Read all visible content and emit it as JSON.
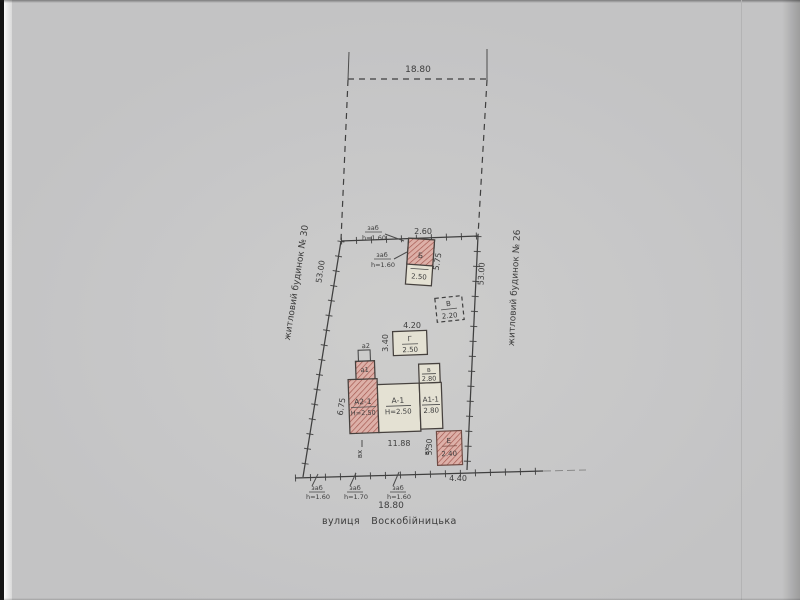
{
  "plan": {
    "street": {
      "prefix": "вулиця",
      "name": "Воскобійницька"
    },
    "neighbor_left": "житловий будинок № 30",
    "neighbor_right": "житловий будинок № 26",
    "dims": {
      "front_top": "18.80",
      "front_bottom": "18.80",
      "side_left": "53.00",
      "side_right": "53.00",
      "corner_right": "4.40"
    },
    "fences": {
      "top_a": {
        "label": "заб",
        "height": "h=1.60"
      },
      "top_b": {
        "label": "заб",
        "height": "h=1.60"
      },
      "bottom_a": {
        "label": "заб",
        "height": "h=1.60"
      },
      "bottom_b": {
        "label": "заб",
        "height": "h=1.70"
      },
      "bottom_c": {
        "label": "заб",
        "height": "h=1.60"
      }
    },
    "buildings": {
      "b": {
        "letter": "Б",
        "value": "2.50",
        "width": "2.60",
        "depth": "5.75"
      },
      "v_shed": {
        "letter": "В",
        "value": "2.20"
      },
      "g": {
        "letter": "Г",
        "value": "2.50",
        "width": "4.20",
        "depth": "3.40"
      },
      "house_a2": {
        "label": "А2-1",
        "height": "Н=2.50",
        "side": "6.75"
      },
      "house_a": {
        "label": "А-1",
        "height": "Н=2.50"
      },
      "house_a1": {
        "label": "А1-1",
        "value": "2.80"
      },
      "annex_v": {
        "letter": "в",
        "value": "2.80"
      },
      "porch_a1": {
        "label": "а1"
      },
      "step_a2": {
        "label": "а2"
      },
      "house_width": "11.88",
      "e": {
        "letter": "Е",
        "value": "2.40",
        "depth": "5.30"
      }
    },
    "entrance_left": "вх",
    "entrance_right": "вх"
  }
}
